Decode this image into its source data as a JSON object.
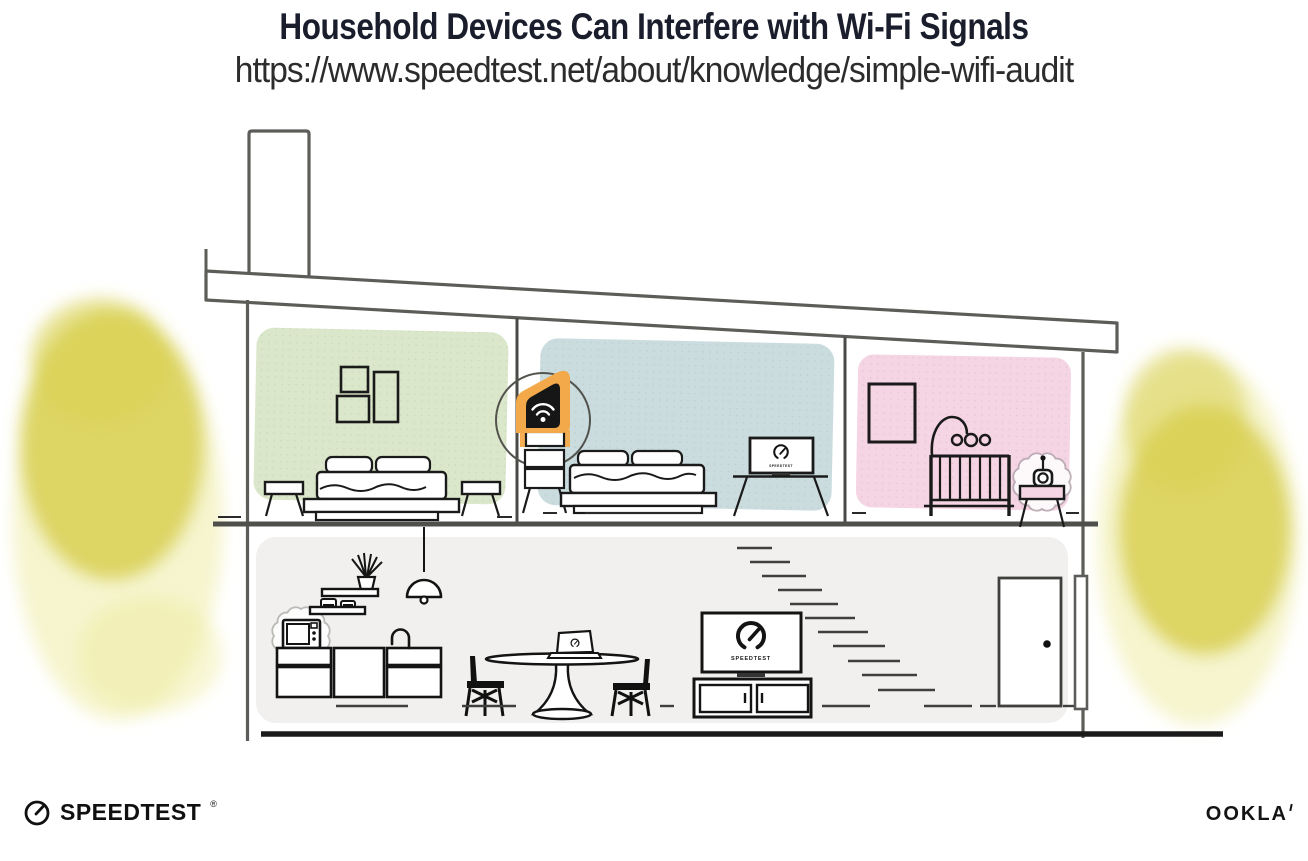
{
  "header": {
    "title": "Household Devices Can Interfere with Wi-Fi Signals",
    "url": "https://www.speedtest.net/about/knowledge/simple-wifi-audit"
  },
  "illustration": {
    "living_room_tv_label": "SPEEDTEST",
    "bedroom_tv_label": "SPEEDTEST",
    "devices_depicted": [
      "wifi-router",
      "microwave",
      "baby-monitor",
      "tv",
      "laptop"
    ]
  },
  "footer": {
    "speedtest_label": "SPEEDTEST",
    "ookla_label": "OOKLA"
  },
  "colors": {
    "title_text": "#1a1e2c",
    "url_text": "#2c2c2c",
    "wall_green": "#dbe7ca",
    "wall_blue": "#cbdcdf",
    "wall_pink": "#f5d4e3",
    "floor_gray": "#f1f0ee",
    "router_orange": "#f3a94a",
    "tree_yellow": "#d8d052",
    "tree_halo": "#eeeb9e",
    "structure_line": "#5c5c58",
    "ink": "#141414"
  }
}
